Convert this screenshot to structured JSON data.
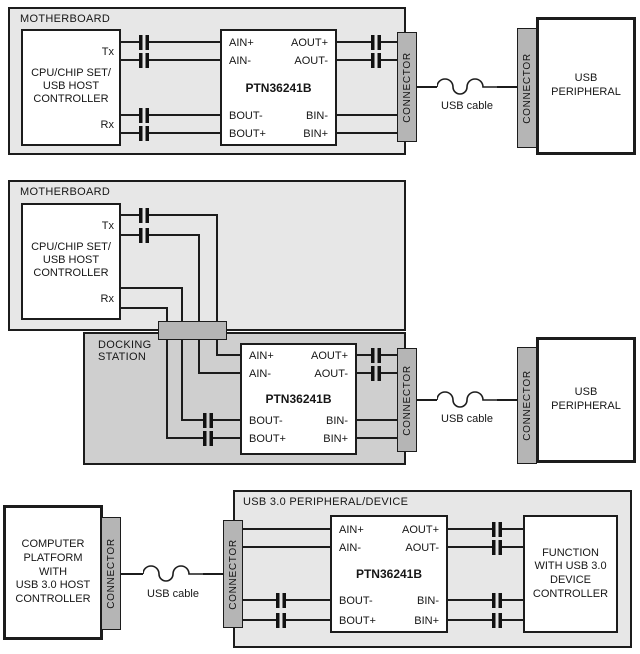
{
  "labels": {
    "motherboard": "MOTHERBOARD",
    "docking_station": "DOCKING\nSTATION",
    "cpu": "CPU/CHIP SET/\nUSB HOST\nCONTROLLER",
    "tx": "Tx",
    "rx": "Rx",
    "chip": "PTN36241B",
    "connector": "CONNECTOR",
    "usb_cable": "USB cable",
    "usb_peripheral": "USB\nPERIPHERAL",
    "computer_platform": "COMPUTER\nPLATFORM\nWITH\nUSB 3.0 HOST\nCONTROLLER",
    "usb3_device_board": "USB 3.0 PERIPHERAL/DEVICE",
    "function_block": "FUNCTION\nWITH USB 3.0\nDEVICE\nCONTROLLER",
    "pins": {
      "ain_p": "AIN+",
      "ain_n": "AIN-",
      "aout_p": "AOUT+",
      "aout_n": "AOUT-",
      "bout_n": "BOUT-",
      "bout_p": "BOUT+",
      "bin_n": "BIN-",
      "bin_p": "BIN+"
    }
  },
  "colors": {
    "board_fill": "#e7e7e7",
    "docking_fill": "#cfcfcf",
    "connector_fill": "#b5b5b5",
    "line": "#1c1c1c",
    "component_fill": "#ffffff"
  }
}
